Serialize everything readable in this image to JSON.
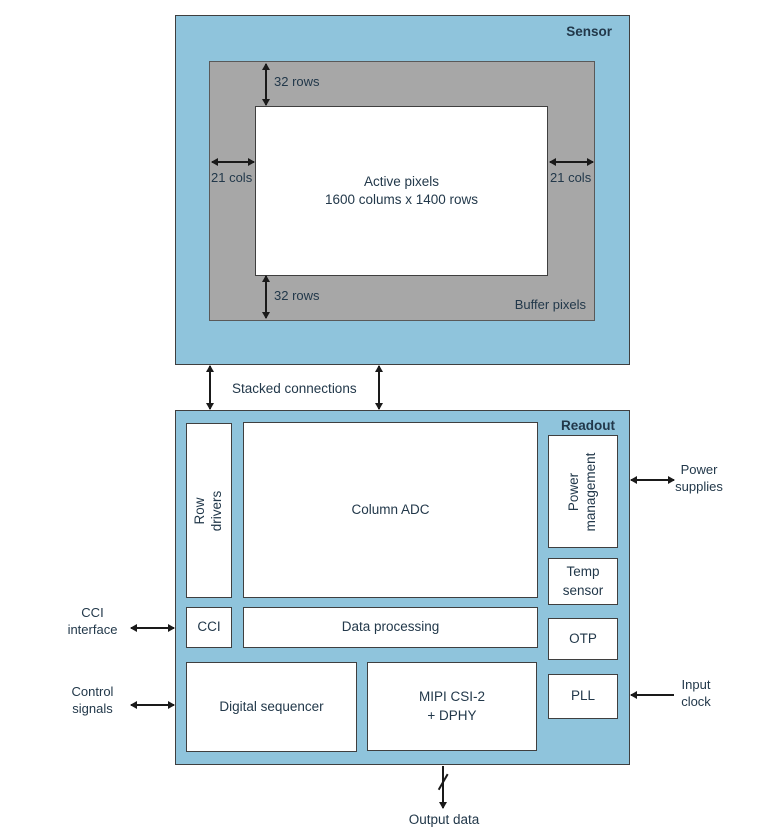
{
  "colors": {
    "panel_blue": "#8FC4DC",
    "buffer_gray": "#A7A7A7",
    "box_border": "#3F3F3F",
    "text": "#22384A",
    "arrow": "#1A1A1A"
  },
  "sensor": {
    "title": "Sensor",
    "buffer_pixels_label": "Buffer pixels",
    "active_pixels_label": "Active pixels\n1600 colums x 1400 rows",
    "top_margin": "32 rows",
    "bottom_margin": "32 rows",
    "left_margin": "21 cols",
    "right_margin": "21 cols"
  },
  "interconnect": {
    "label": "Stacked connections"
  },
  "readout": {
    "title": "Readout",
    "row_drivers": "Row drivers",
    "column_adc": "Column ADC",
    "power_management": "Power\nmanagement",
    "temp_sensor": "Temp\nsensor",
    "cci": "CCI",
    "data_processing": "Data processing",
    "otp": "OTP",
    "digital_sequencer": "Digital sequencer",
    "mipi": "MIPI CSI-2\n+ DPHY",
    "pll": "PLL"
  },
  "external": {
    "cci_interface": "CCI\ninterface",
    "control_signals": "Control\nsignals",
    "power_supplies": "Power\nsupplies",
    "input_clock": "Input\nclock",
    "output_data": "Output data"
  }
}
